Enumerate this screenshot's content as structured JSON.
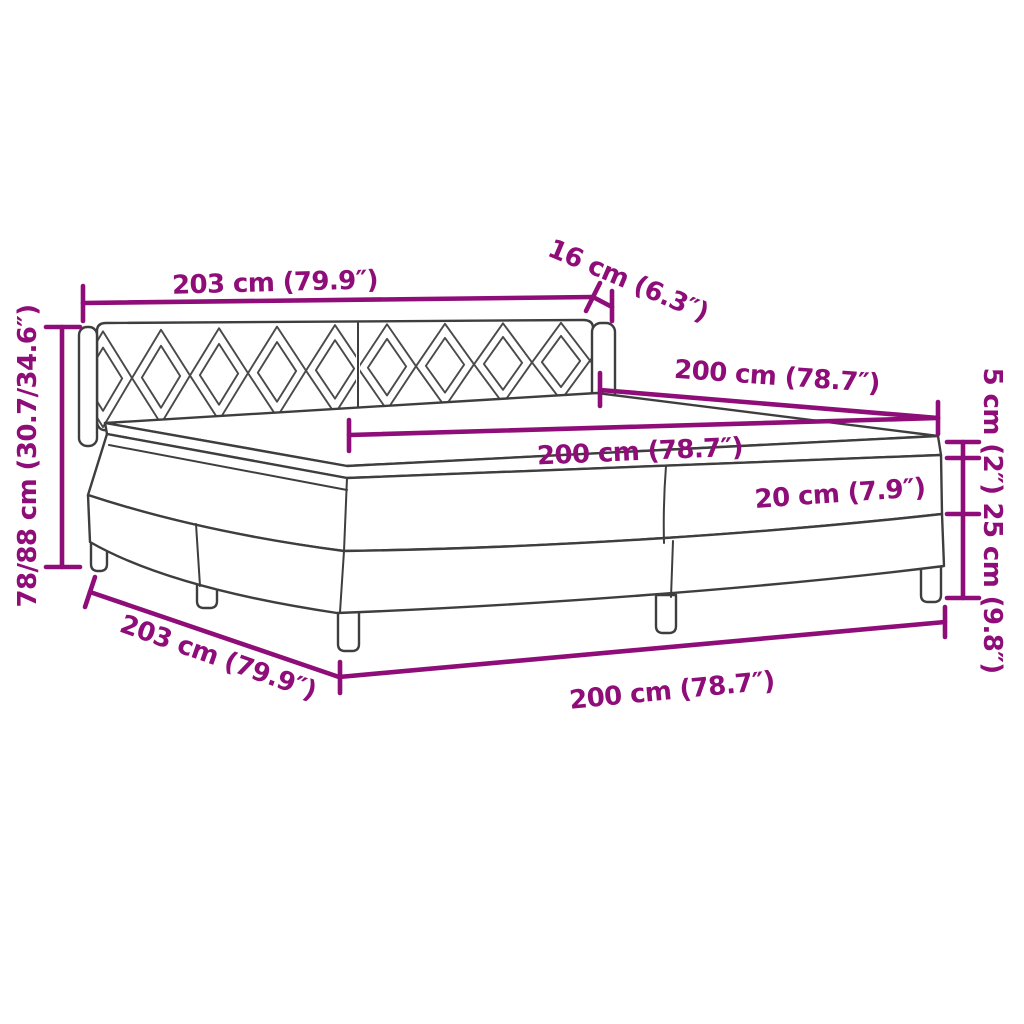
{
  "diagram": {
    "type": "product-dimension-diagram",
    "subject": "box-spring-bed-with-diamond-pattern-headboard",
    "background": "#ffffff",
    "accent_color": "#8e0d78",
    "outline_color": "#3e3e3e",
    "labels": {
      "headboard_width": "203 cm (79.9″)",
      "headboard_depth": "16 cm (6.3″)",
      "bed_length_top": "200 cm (78.7″)",
      "mattress_length": "200 cm (78.7″)",
      "topper_height": "5 cm (2″)",
      "mattress_height": "20 cm (7.9″)",
      "base_height": "25 cm (9.8″)",
      "total_height": "78/88 cm (30.7/34.6″)",
      "base_width_bottom": "203 cm (79.9″)",
      "bed_length_bottom": "200 cm (78.7″)"
    }
  }
}
